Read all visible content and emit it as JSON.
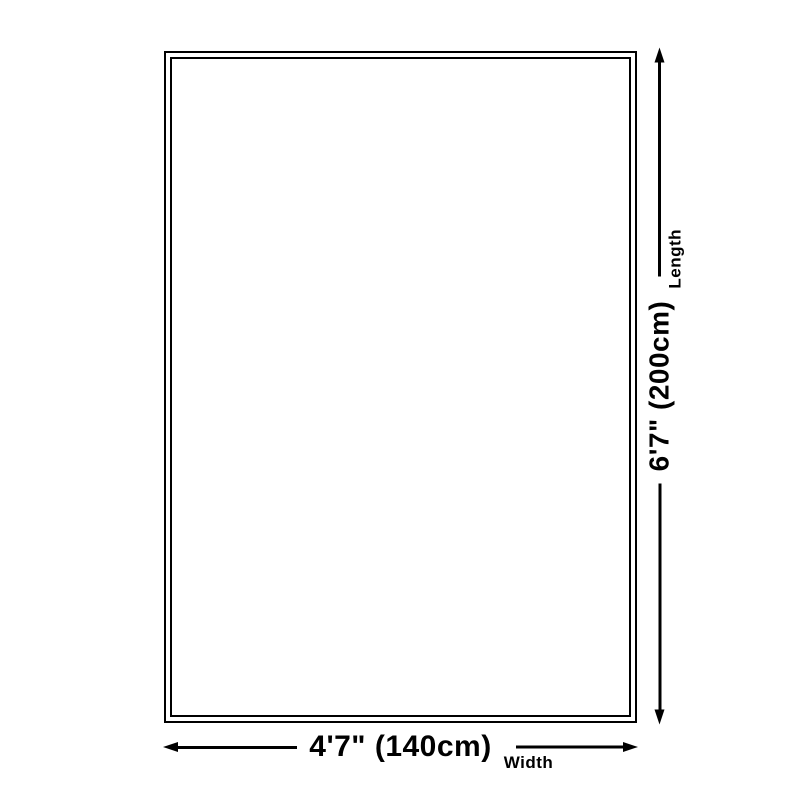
{
  "diagram_title": "rug-size-diagram",
  "dimensions": {
    "length": {
      "value": "6'7\" (200cm)",
      "axis_label": "Length"
    },
    "width": {
      "value": "4'7\" (140cm)",
      "axis_label": "Width"
    }
  },
  "colors": {
    "line": "#000000",
    "background": "#ffffff"
  },
  "icons": {
    "arrow_left": "left-pointing solid triangle",
    "arrow_right": "right-pointing solid triangle",
    "arrow_up": "up-pointing solid triangle",
    "arrow_down": "down-pointing solid triangle"
  }
}
